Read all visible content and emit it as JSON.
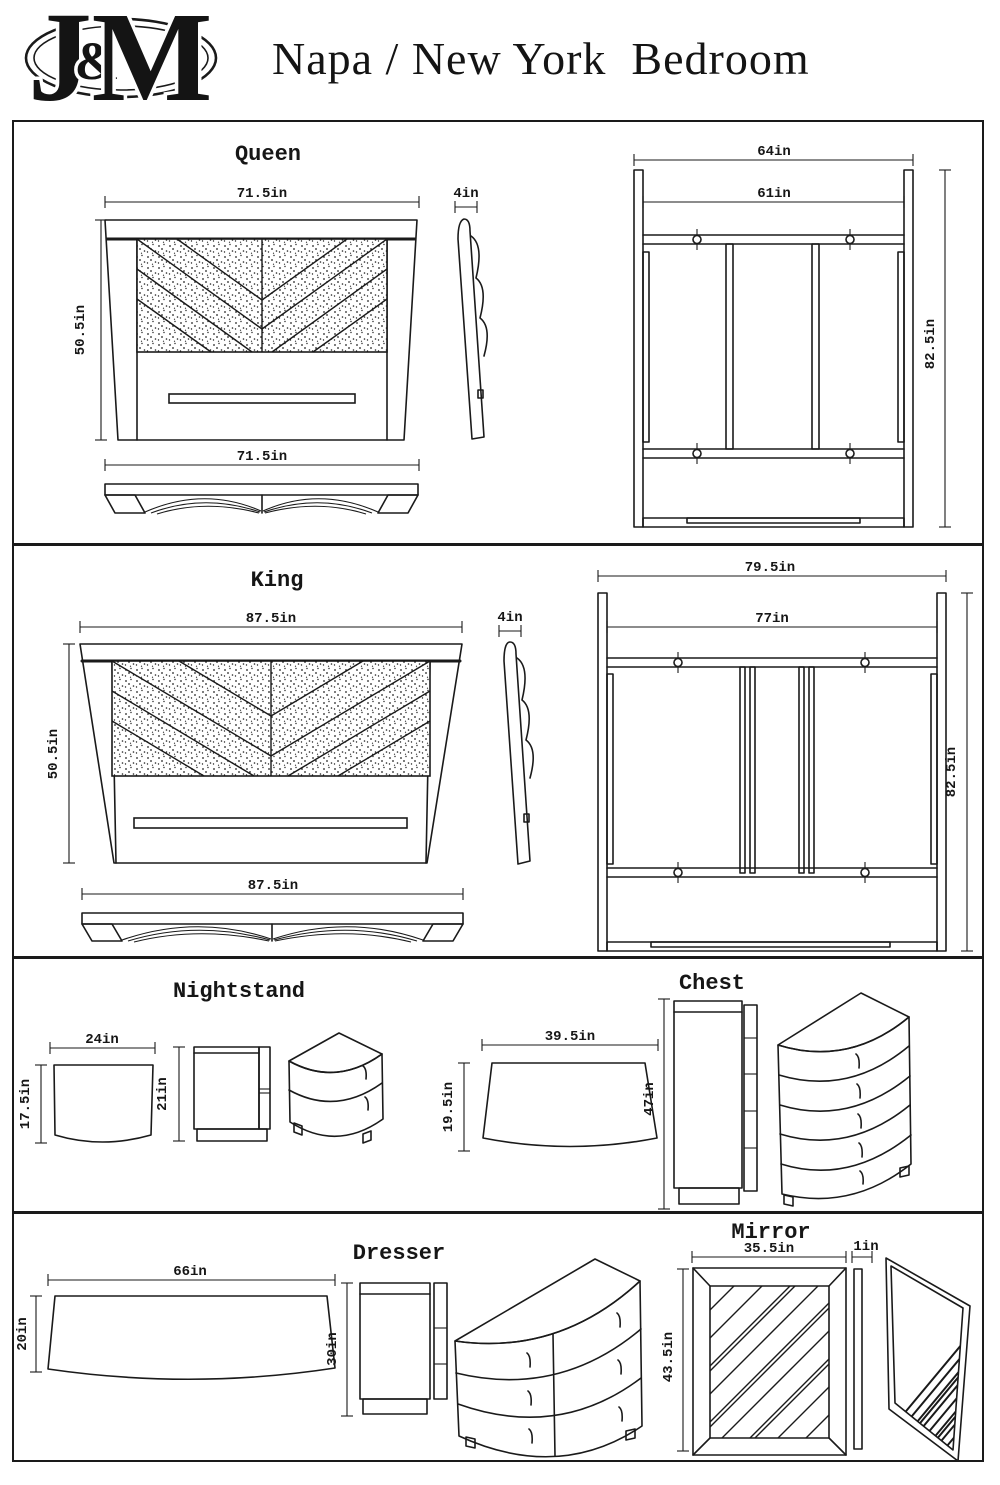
{
  "header": {
    "logo": {
      "j": "J",
      "amp": "&",
      "m": "M"
    },
    "title": "Napa / New York  Bedroom"
  },
  "queen": {
    "title": "Queen",
    "front_width": "71.5in",
    "front_height": "50.5in",
    "side_depth": "4in",
    "footboard_width": "71.5in",
    "frame_outer_width": "64in",
    "frame_inner_width": "61in",
    "frame_length": "82.5in"
  },
  "king": {
    "title": "King",
    "front_width": "87.5in",
    "front_height": "50.5in",
    "side_depth": "4in",
    "footboard_width": "87.5in",
    "frame_outer_width": "79.5in",
    "frame_inner_width": "77in",
    "frame_length": "82.5in"
  },
  "nightstand": {
    "title": "Nightstand",
    "top_width": "24in",
    "top_depth": "17.5in",
    "height": "21in"
  },
  "chest": {
    "title": "Chest",
    "top_width": "39.5in",
    "top_depth": "19.5in",
    "height": "47in"
  },
  "dresser": {
    "title": "Dresser",
    "top_width": "66in",
    "top_depth": "20in",
    "height": "30in"
  },
  "mirror": {
    "title": "Mirror",
    "width": "35.5in",
    "thickness": "1in",
    "height": "43.5in"
  },
  "colors": {
    "ink": "#1a1a1a",
    "paper": "#ffffff"
  }
}
